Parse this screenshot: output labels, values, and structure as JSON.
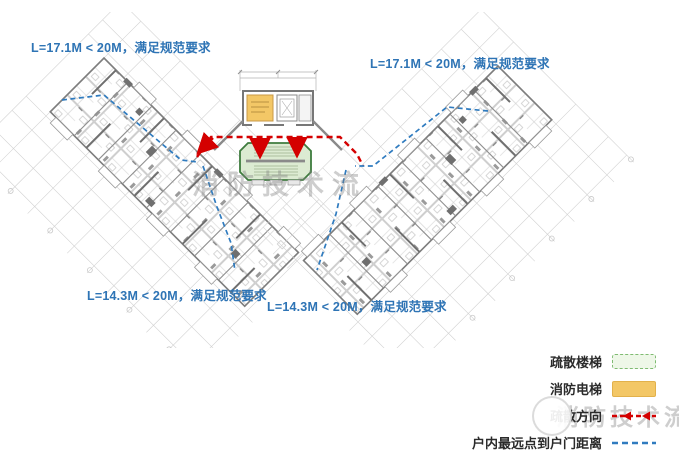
{
  "annotations": {
    "top_left": "L=17.1M < 20M，满足规范要求",
    "top_right": "L=17.1M < 20M，满足规范要求",
    "bottom_left": "L=14.3M < 20M，满足规范要求",
    "bottom_center": "L=14.3M < 20M，满足规范要求"
  },
  "legend": {
    "items": [
      {
        "label": "疏散楼梯",
        "swatch": "green-dashed-box-icon",
        "color": "#eef7e8"
      },
      {
        "label": "消防电梯",
        "swatch": "amber-box-icon",
        "color": "#f3c766"
      },
      {
        "label": "疏散方向",
        "swatch": "red-dashed-arrow-icon",
        "color": "#d40000"
      },
      {
        "label": "户内最远点到户门距离",
        "swatch": "blue-dashed-line-icon",
        "color": "#2f7bbf"
      }
    ]
  },
  "watermark": {
    "text": "消防技术流"
  },
  "colors": {
    "annotation_blue": "#2e74b5",
    "route_red": "#d40000",
    "distance_blue": "#2f7bbf",
    "stair_green_fill": "#dcebd2",
    "stair_green_border": "#3e7c3e",
    "fire_elevator_amber": "#f3c766",
    "plan_wall_gray": "#7d7d7d"
  }
}
